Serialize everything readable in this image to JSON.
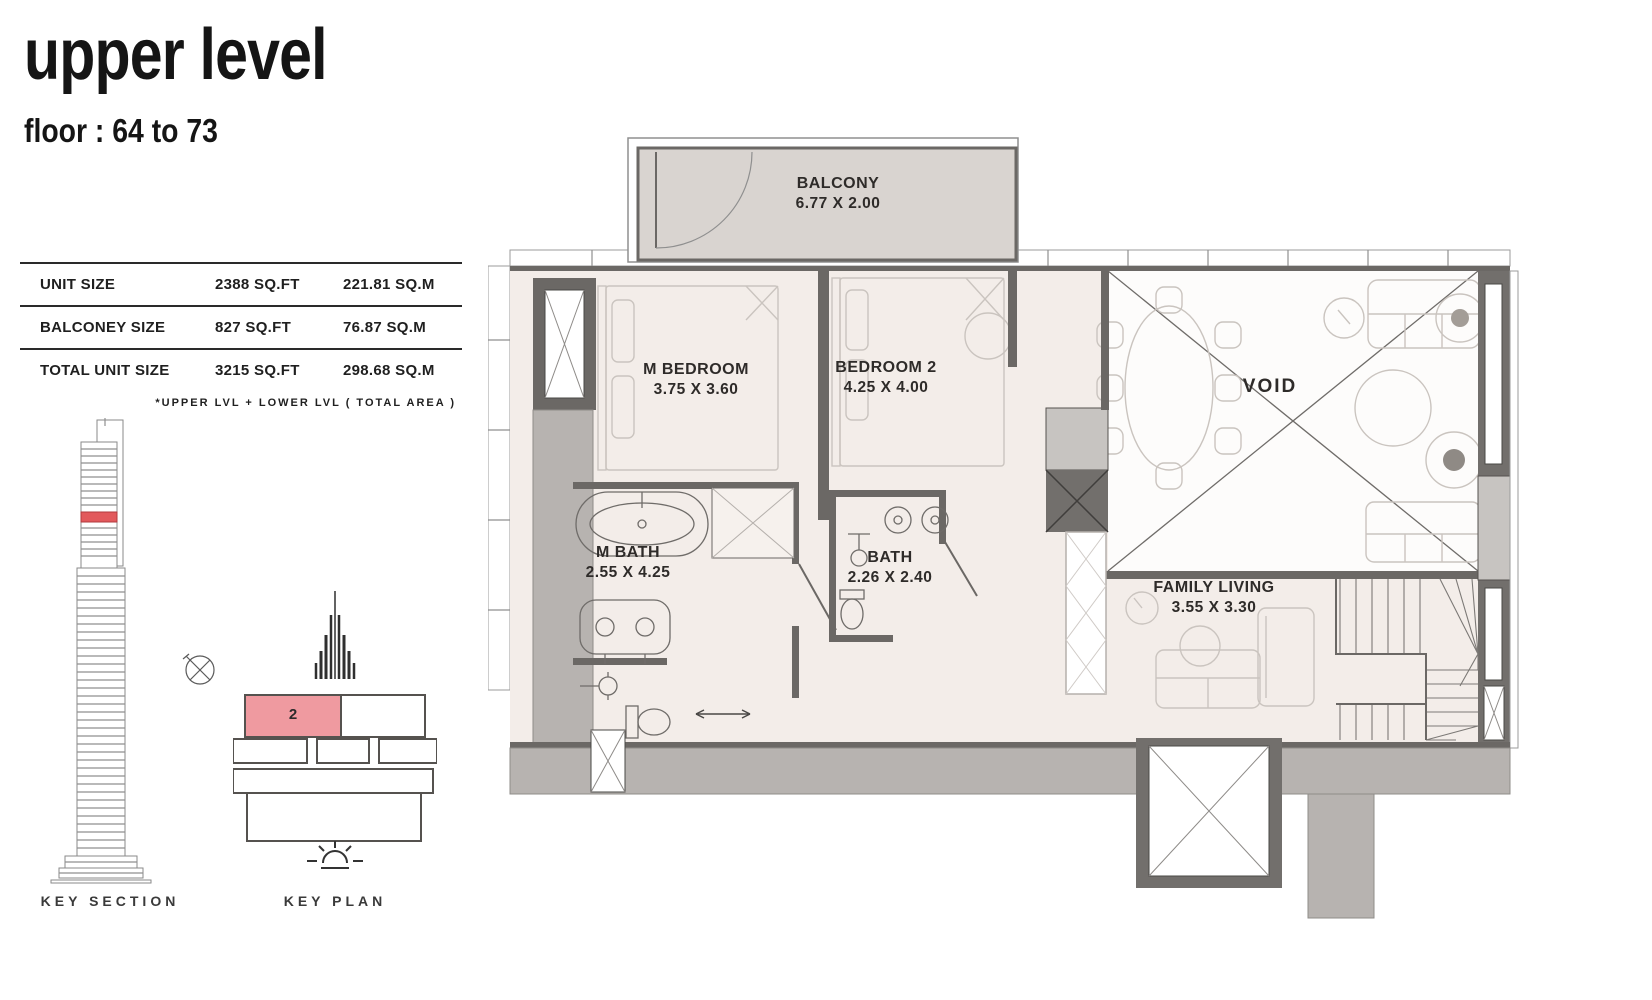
{
  "header": {
    "title": "upper level",
    "subtitle": "floor : 64 to 73"
  },
  "size_table": {
    "rows": [
      {
        "label": "UNIT SIZE",
        "sqft": "2388 SQ.FT",
        "sqm": "221.81  SQ.M"
      },
      {
        "label": "BALCONEY SIZE",
        "sqft": "827  SQ.FT",
        "sqm": "76.87  SQ.M"
      },
      {
        "label": "TOTAL UNIT SIZE",
        "sqft": "3215 SQ.FT",
        "sqm": "298.68  SQ.M"
      }
    ],
    "footnote": "*UPPER  LVL + LOWER  LVL ( TOTAL AREA )"
  },
  "key_section": {
    "label": "KEY SECTION"
  },
  "key_plan": {
    "label": "KEY PLAN",
    "unit_number": "2"
  },
  "floor_plan": {
    "rooms": [
      {
        "name": "BALCONY",
        "dims": "6.77 X 2.00"
      },
      {
        "name": "M  BEDROOM",
        "dims": "3.75 X 3.60"
      },
      {
        "name": "BEDROOM 2",
        "dims": "4.25 X 4.00"
      },
      {
        "name": "M BATH",
        "dims": "2.55 X 4.25"
      },
      {
        "name": "BATH",
        "dims": "2.26 X 2.40"
      },
      {
        "name": "VOID",
        "dims": ""
      },
      {
        "name": "FAMILY LIVING",
        "dims": "3.55 X 3.30"
      }
    ]
  },
  "colors": {
    "unit_highlight": "#ef9aa0",
    "section_highlight": "#e2595c",
    "floor_fill": "#f3ede9",
    "balcony_fill": "#d9d4d0",
    "wall_dark": "#6b6865",
    "wall_gray": "#b7b3b0"
  }
}
